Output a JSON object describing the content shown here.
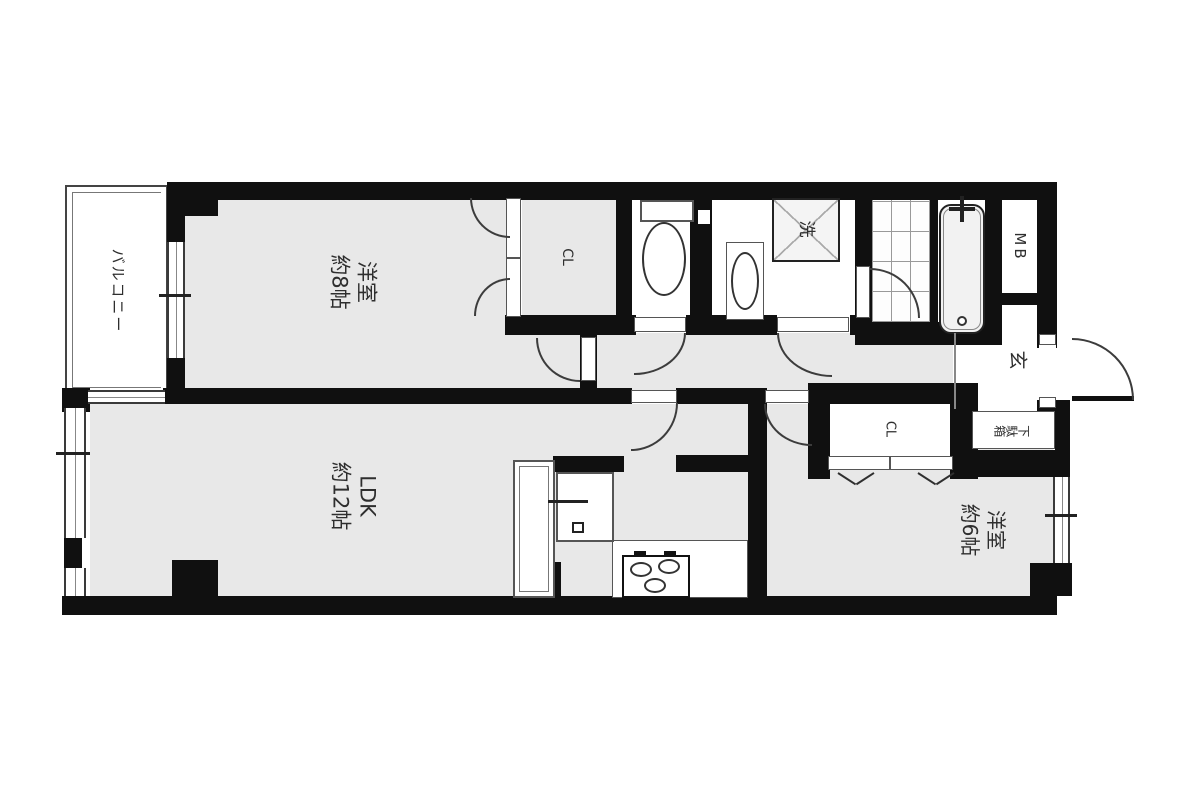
{
  "plan": {
    "balcony_label": "バルコニー",
    "rooms": {
      "bedroom1": {
        "name": "洋室",
        "size": "約8帖"
      },
      "ldk": {
        "name": "LDK",
        "size": "約12帖"
      },
      "bedroom2": {
        "name": "洋室",
        "size": "約6帖"
      }
    },
    "labels": {
      "closet1": "CL",
      "closet2": "CL",
      "meter_box": "MB",
      "entrance": "玄",
      "shoe_cabinet": "下駄箱",
      "laundry": "洗"
    },
    "colors": {
      "wall": "#101010",
      "room_fill": "#e8e8e8",
      "line": "#3c3c3c"
    }
  }
}
